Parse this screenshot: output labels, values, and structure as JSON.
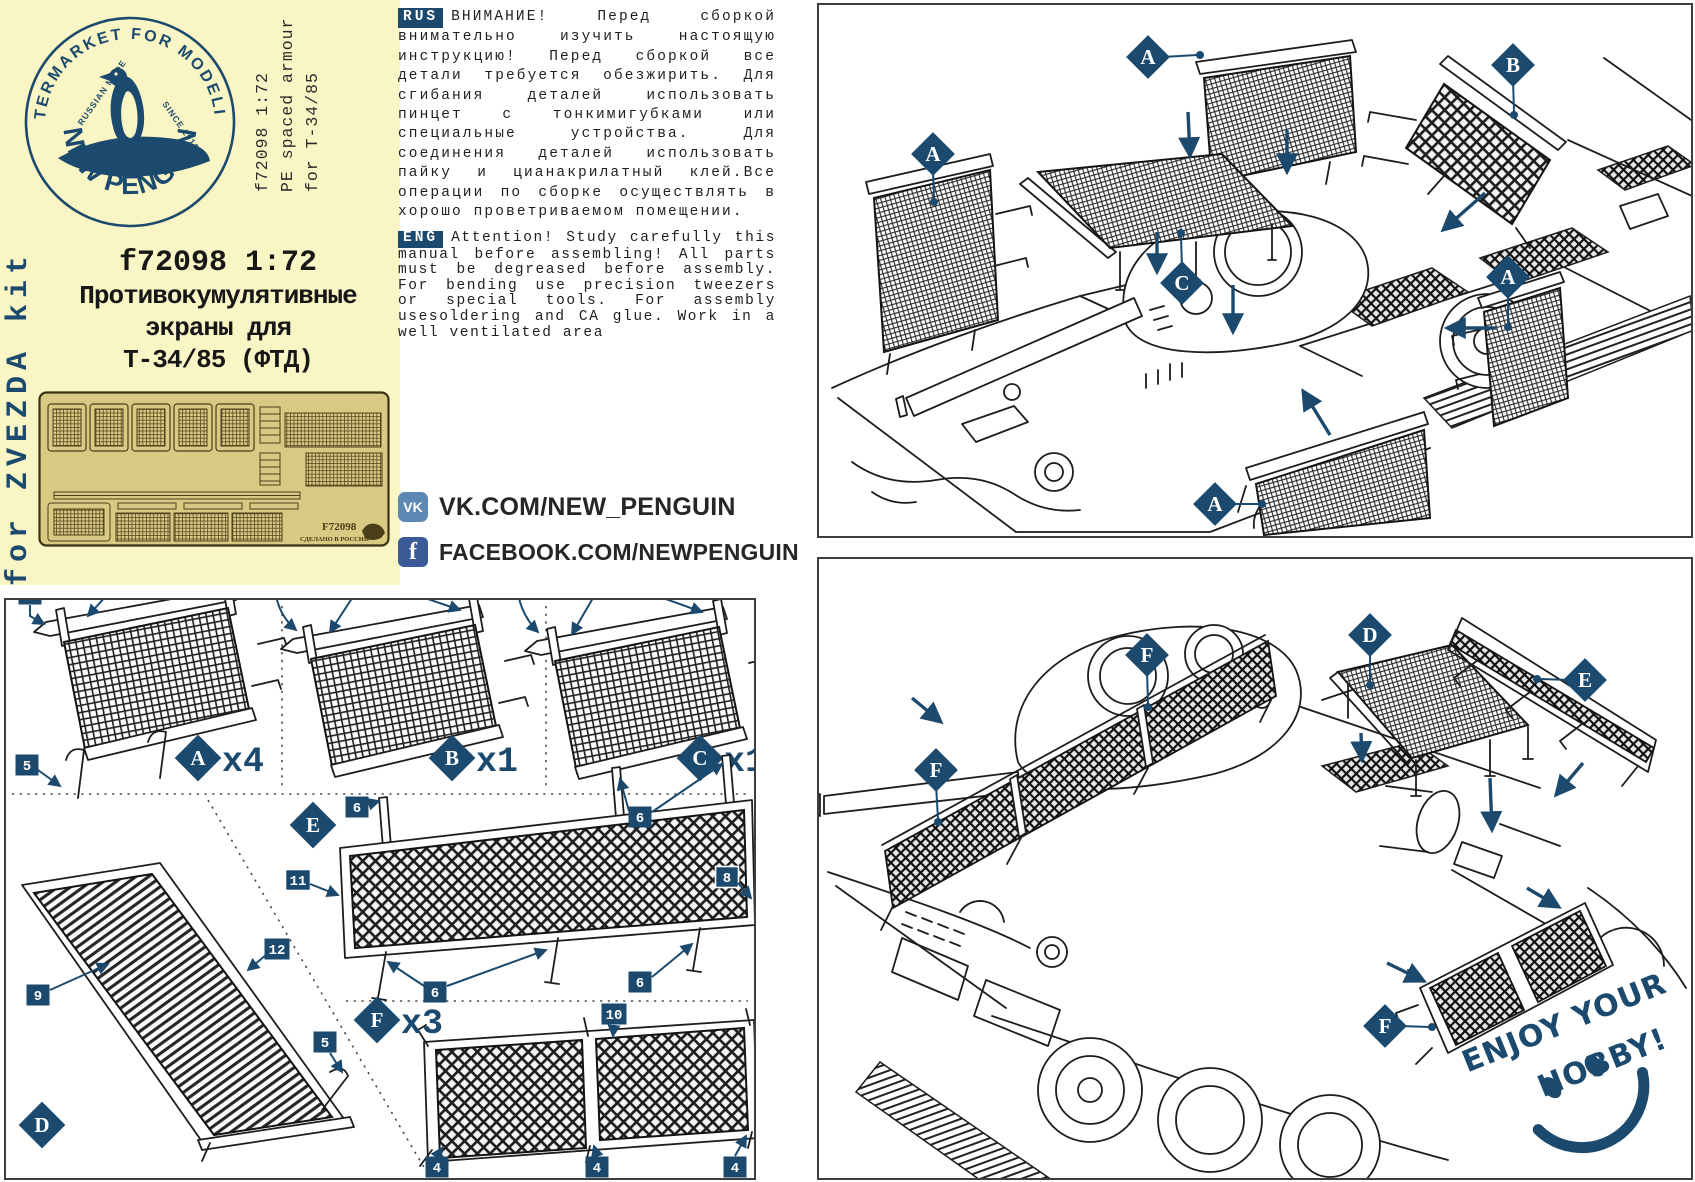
{
  "brand": {
    "arc_top": "AFTERMARKET FOR MODELING",
    "russian_made": "RUSSIAN MADE",
    "since": "SINCE 2013",
    "name": "NEW PENGUIN"
  },
  "product": {
    "side_line1": "f72098 1:72",
    "side_line2": "PE spaced armour",
    "side_line3": "for T-34/85",
    "title_line1": "f72098 1:72",
    "title_line2": "Противокумулятивные",
    "title_line3": "экраны для",
    "title_line4": "Т-34/85 (ФТД)",
    "kit_note": "for ZVEZDA kit"
  },
  "fret": {
    "code": "F72098",
    "made_in": "СДЕЛАНО В РОССИИ"
  },
  "notes": {
    "rus_badge": "RUS",
    "rus_text": "ВНИМАНИЕ! Перед сборкой внимательно изучить настоящую инструкцию! Перед сборкой все детали требуется обезжирить. Для сгибания деталей использовать пинцет с тонкимигубками или специальные устройства. Для соединения деталей использовать пайку и цианакрилатный клей.Все операции по сборке осуществлять в хорошо проветриваемом помещении.",
    "eng_badge": "ENG",
    "eng_text": "Attention! Study carefully this manual before assembling! All parts must be degreased before assembly. For bending use precision tweezers or special tools. For assembly usesoldering and CA glue. Work in a well ventilated area"
  },
  "social": {
    "vk_icon": "VK",
    "vk_label": "VK.COM/NEW_PENGUIN",
    "fb_icon": "f",
    "fb_label": "FACEBOOK.COM/NEWPENGUIN"
  },
  "parts": {
    "a": {
      "letter": "A",
      "qty": "x4",
      "co_7": "7",
      "co_num": "1"
    },
    "b": {
      "letter": "B",
      "qty": "x1",
      "co_7": "7",
      "co_num": "2"
    },
    "c": {
      "letter": "C",
      "qty": "x1",
      "co_7": "7",
      "co_num": "3"
    },
    "d": {
      "letter": "D",
      "co_1": "5",
      "co_2": "9",
      "co_3": "12",
      "co_4": "5"
    },
    "e": {
      "letter": "E",
      "co_1": "6",
      "co_2": "6",
      "co_3": "11",
      "co_4": "8",
      "co_5": "6",
      "co_6": "6"
    },
    "f": {
      "letter": "F",
      "qty": "x3",
      "co_1": "10",
      "co_2": "4",
      "co_3": "4",
      "co_4": "4"
    }
  },
  "assembly_top": {
    "labels": [
      "A",
      "B",
      "A",
      "C",
      "A",
      "A"
    ]
  },
  "assembly_bottom": {
    "labels": [
      "F",
      "D",
      "E",
      "F",
      "F"
    ],
    "slogan1": "ENJOY YOUR",
    "slogan2": "HOBBY!"
  },
  "colors": {
    "accent": "#1B4A6E",
    "cream": "#FAF5C4",
    "fret_brass": "#D8CA83",
    "vk_blue": "#5C88B4",
    "fb_blue": "#3A5A98",
    "ink": "#1D1D1D"
  }
}
